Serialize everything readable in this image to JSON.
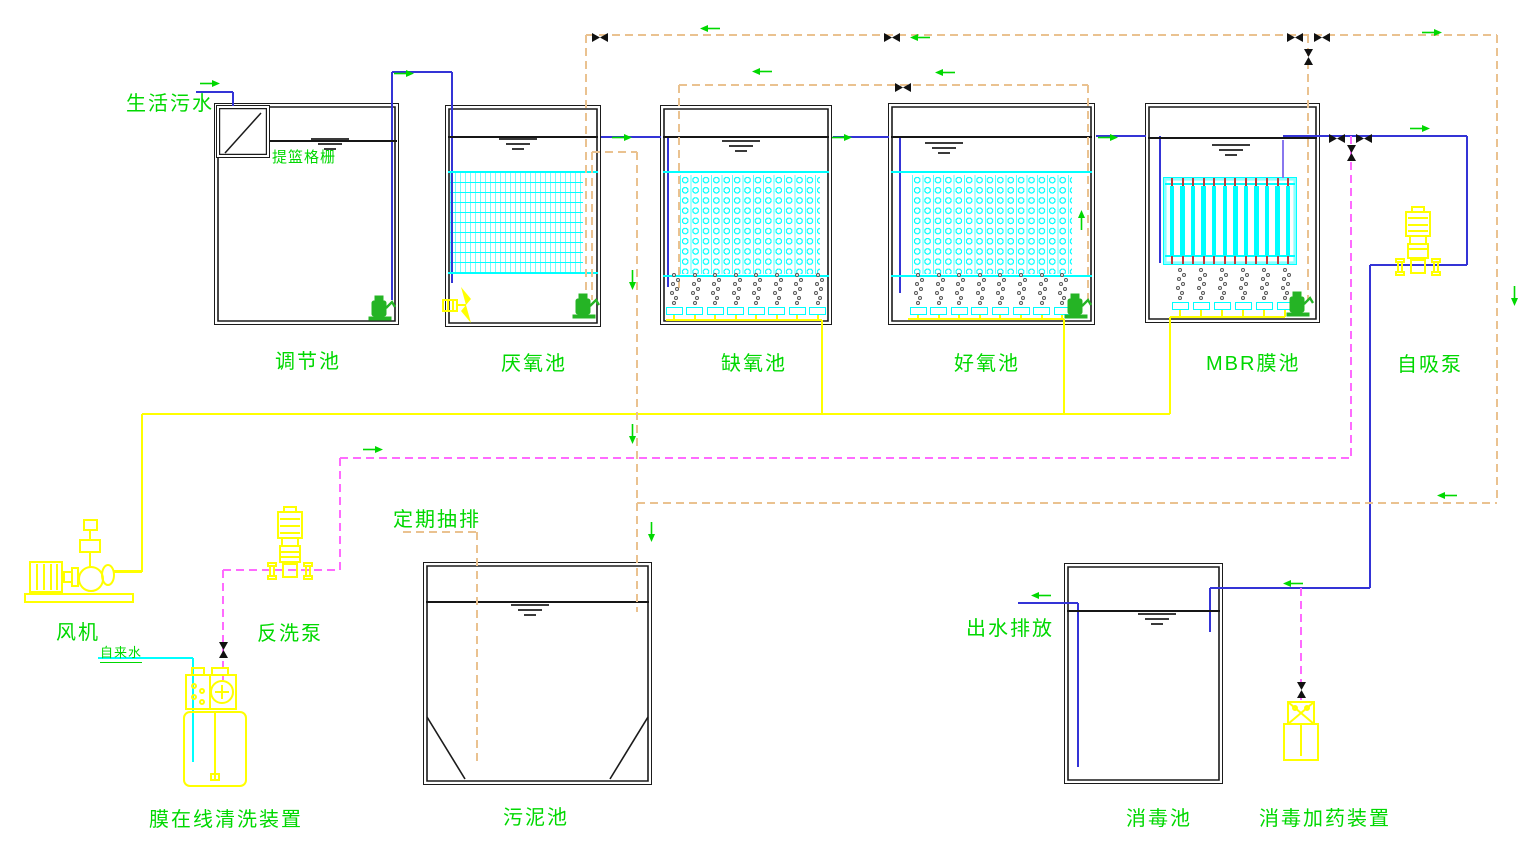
{
  "labels": {
    "influent": "生活污水",
    "basket_screen": "提篮格栅",
    "regulation_tank": "调节池",
    "anaerobic_tank": "厌氧池",
    "anoxic_tank": "缺氧池",
    "aerobic_tank": "好氧池",
    "mbr_tank": "MBR膜池",
    "self_priming_pump": "自吸泵",
    "blower": "风机",
    "backwash_pump": "反洗泵",
    "tap_water": "自来水",
    "membrane_cleaning_unit": "膜在线清洗装置",
    "periodic_discharge": "定期抽排",
    "sludge_tank": "污泥池",
    "effluent_discharge": "出水排放",
    "disinfection_tank": "消毒池",
    "disinfection_dosing_unit": "消毒加药装置"
  },
  "colors": {
    "label_text": "#00d800",
    "flow_arrow": "#00d800",
    "water_pipe": "#3434d6",
    "permeate_pipe": "#8877ee",
    "surface_line": "#161616",
    "air_pipe": "#ffff00",
    "sludge_pipe": "#eac290",
    "chemical_pipe": "#ff6bff",
    "tap_water_pipe": "#00ffff",
    "media": "#00ffff",
    "membrane_tick": "#c03a3a",
    "equipment": "#ffff00",
    "submersible_pump": "#25b425",
    "valve": "#111111",
    "tank_wall": "#1b1b1b"
  }
}
